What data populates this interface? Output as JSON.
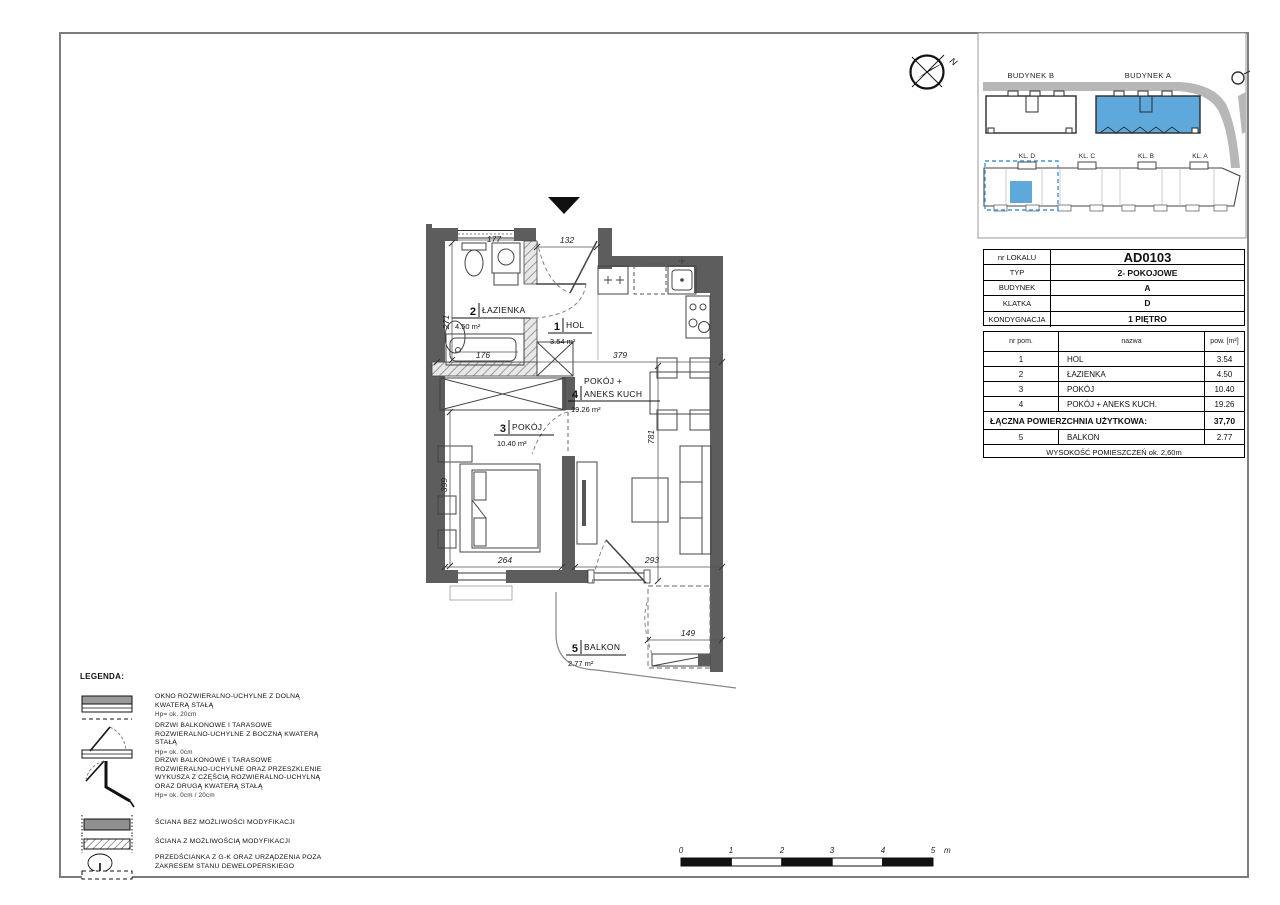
{
  "colors": {
    "highlight_blue": "#5FA8DC",
    "wall_gray": "#5d5d5d"
  },
  "compass": {
    "north_label": "N"
  },
  "site_plan": {
    "building_b_label": "BUDYNEK B",
    "building_a_label": "BUDYNEK A",
    "stair_labels": [
      "KL. D",
      "KL. C",
      "KL. B",
      "KL. A"
    ]
  },
  "info_table": {
    "rows": [
      {
        "label": "nr LOKALU",
        "value": "AD0103"
      },
      {
        "label": "TYP",
        "value": "2- POKOJOWE"
      },
      {
        "label": "BUDYNEK",
        "value": "A"
      },
      {
        "label": "KLATKA",
        "value": "D"
      },
      {
        "label": "KONDYGNACJA",
        "value": "1 PIĘTRO"
      }
    ]
  },
  "rooms_table": {
    "header": {
      "nr": "nr pom.",
      "name": "nazwa",
      "area": "pow. [m²]"
    },
    "rows": [
      {
        "nr": "1",
        "name": "HOL",
        "area": "3.54"
      },
      {
        "nr": "2",
        "name": "ŁAZIENKA",
        "area": "4.50"
      },
      {
        "nr": "3",
        "name": "POKÓJ",
        "area": "10.40"
      },
      {
        "nr": "4",
        "name": "POKÓJ + ANEKS KUCH.",
        "area": "19.26"
      }
    ],
    "total_label": "ŁĄCZNA POWIERZCHNIA UŻYTKOWA:",
    "total_value": "37,70",
    "balcony_row": {
      "nr": "5",
      "name": "BALKON",
      "area": "2.77"
    },
    "footer": "WYSOKOŚĆ POMIESZCZEŃ ok. 2,60m"
  },
  "plan_labels": {
    "hol": {
      "nr": "1",
      "name": "HOL",
      "area": "3.54 m²"
    },
    "bathroom": {
      "nr": "2",
      "name": "ŁAZIENKA",
      "area": "4.50 m²"
    },
    "bedroom": {
      "nr": "3",
      "name": "POKÓJ",
      "area": "10.40 m²"
    },
    "living": {
      "nr": "4",
      "name_line1": "POKÓJ +",
      "name_line2": "ANEKS KUCH",
      "area": "19.26 m²"
    },
    "balcony": {
      "nr": "5",
      "name": "BALKON",
      "area": "2.77 m²"
    }
  },
  "dimensions": {
    "entry_door": "132",
    "bath_width": "177",
    "bath_depth": "271",
    "bathtub_length": "176",
    "living_width": "379",
    "living_depth": "781",
    "bedroom_width": "264",
    "bedroom_depth": "399",
    "living_bottom_width": "293",
    "balcony_width": "149"
  },
  "legend": {
    "title": "LEGENDA:",
    "items": [
      {
        "lines": [
          "OKNO ROZWIERALNO-UCHYLNE Z DOLNĄ",
          "KWATERĄ STAŁĄ"
        ],
        "note": "Hp= ok. 20cm"
      },
      {
        "lines": [
          "DRZWI BALKONOWE I TARASOWE",
          "ROZWIERALNO-UCHYLNE Z BOCZNĄ KWATERĄ",
          "STAŁĄ"
        ],
        "note": "Hp= ok. 0cm"
      },
      {
        "lines": [
          "DRZWI BALKONOWE I TARASOWE",
          "ROZWIERALNO-UCHYLNE ORAZ PRZESZKLENIE",
          "WYKUSZA Z CZĘŚCIĄ ROZWIERALNO-UCHYLNĄ",
          "ORAZ DRUGĄ KWATERĄ STAŁĄ"
        ],
        "note": "Hp= ok. 0cm / 20cm"
      },
      {
        "lines": [
          "ŚCIANA BEZ MOŻLIWOŚCI MODYFIKACJI"
        ],
        "note": ""
      },
      {
        "lines": [
          "ŚCIANA Z MOŻLIWOŚCIĄ MODYFIKACJI"
        ],
        "note": ""
      },
      {
        "lines": [
          "PRZEDŚCIANKA Z G-K ORAZ URZĄDZENIA POZA",
          "ZAKRESEM STANU DEWELOPERSKIEGO"
        ],
        "note": ""
      }
    ]
  },
  "scale_bar": {
    "ticks": [
      "0",
      "1",
      "2",
      "3",
      "4",
      "5"
    ],
    "unit": "m"
  }
}
